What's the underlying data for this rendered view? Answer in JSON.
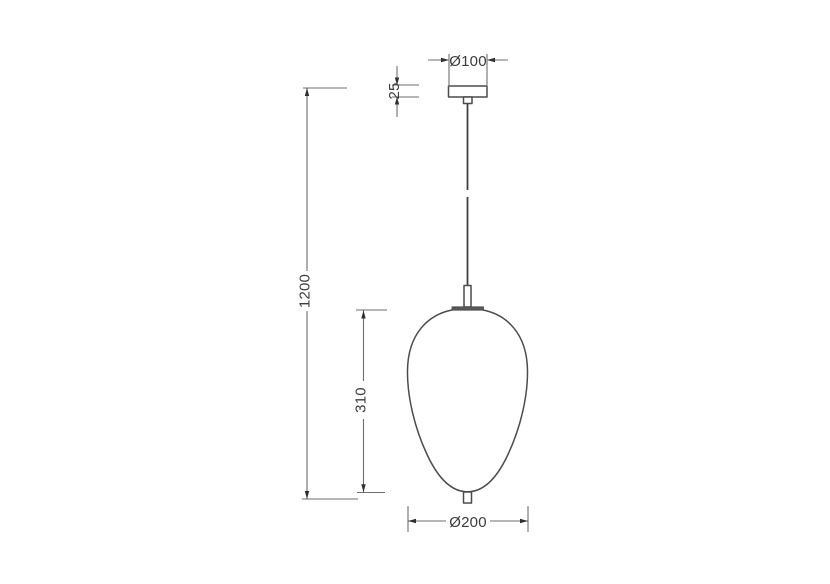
{
  "drawing": {
    "type": "technical-dimension-drawing",
    "subject": "pendant-lamp",
    "dimensions": {
      "canopy_diameter": {
        "label": "Ø100",
        "value_mm": 100,
        "orientation": "horizontal"
      },
      "canopy_height": {
        "label": "25",
        "value_mm": 25,
        "orientation": "vertical"
      },
      "overall_drop": {
        "label": "1200",
        "value_mm": 1200,
        "orientation": "vertical"
      },
      "shade_height": {
        "label": "310",
        "value_mm": 310,
        "orientation": "vertical"
      },
      "shade_diameter": {
        "label": "Ø200",
        "value_mm": 200,
        "orientation": "horizontal"
      }
    },
    "colors": {
      "background": "#ffffff",
      "object_stroke": "#4c4c4c",
      "cord_stroke": "#3f3f3f",
      "dimension_line": "#6e6e6e",
      "arrowhead": "#2f2f2f",
      "label_text": "#3c3c3c"
    }
  }
}
